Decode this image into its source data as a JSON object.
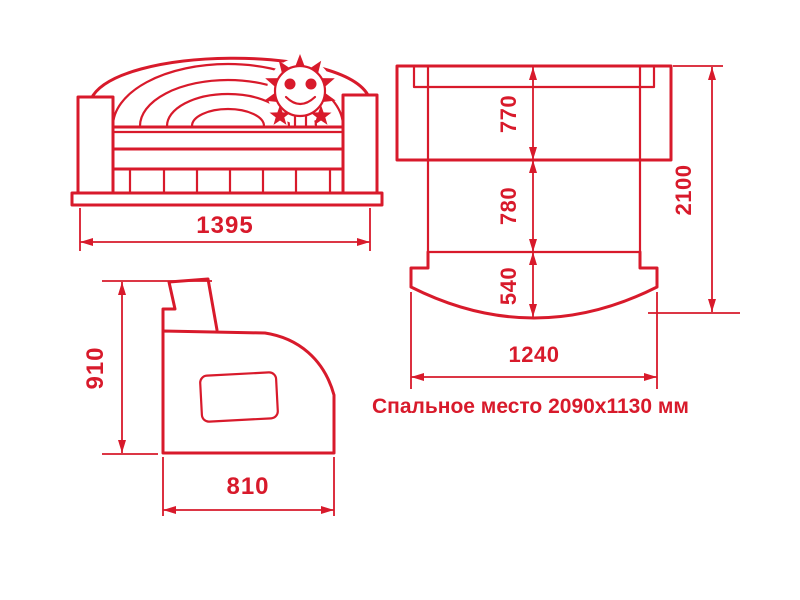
{
  "colors": {
    "line": "#d81a2b",
    "background": "#ffffff"
  },
  "views": {
    "front": {
      "width_label": "1395"
    },
    "top": {
      "section_labels": [
        "770",
        "780",
        "540"
      ],
      "total_length_label": "2100",
      "width_label": "1240"
    },
    "side": {
      "height_label": "910",
      "depth_label": "810"
    }
  },
  "caption": {
    "text": "Спальное место 2090x1130 мм"
  },
  "icons": {
    "sun": "sun-smiley-icon"
  }
}
